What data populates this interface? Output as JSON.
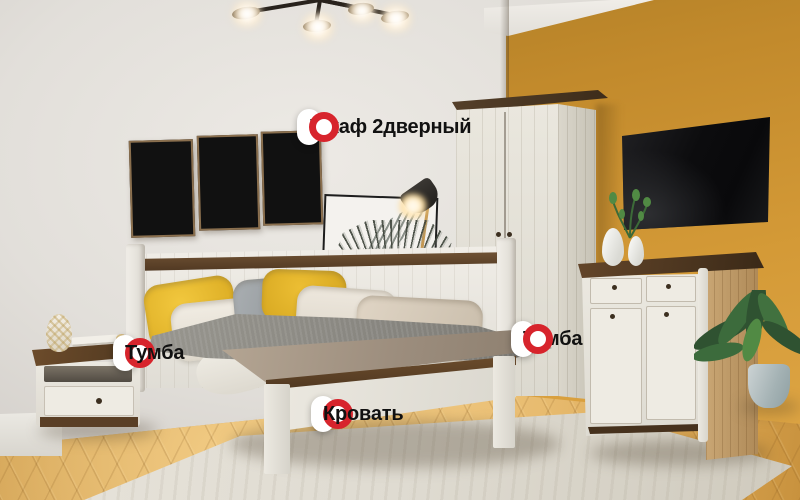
{
  "scene": {
    "description": "bedroom furniture showcase with product hotspots",
    "furniture": [
      {
        "name": "wardrobe-2-door"
      },
      {
        "name": "bed"
      },
      {
        "name": "nightstand"
      },
      {
        "name": "dresser"
      },
      {
        "name": "tv"
      },
      {
        "name": "wall-art-triptych"
      },
      {
        "name": "ceiling-lamp"
      },
      {
        "name": "floor-lamp"
      },
      {
        "name": "potted-plant"
      }
    ]
  },
  "hotspots": [
    {
      "id": "wardrobe",
      "label": "Шкаф 2дверный",
      "marker_side": "right"
    },
    {
      "id": "nightstand",
      "label": "Тумба",
      "marker_side": "left"
    },
    {
      "id": "dresser",
      "label": "Тумба",
      "marker_side": "right"
    },
    {
      "id": "bed",
      "label": "Кровать",
      "marker_side": "left"
    }
  ],
  "colors": {
    "accent_red": "#D7242C",
    "pill_bg": "#FFFFFF",
    "pill_text": "#111111",
    "wall_left": "#DBD7D2",
    "wall_accent": "#CE9433",
    "floor_wood": "#D8A553",
    "furniture_white": "#E9E6DE",
    "wood_dark": "#5D4226",
    "textile_yellow": "#E8B92C",
    "textile_gray": "#9AA0A4",
    "plant_green": "#3C6A38"
  }
}
